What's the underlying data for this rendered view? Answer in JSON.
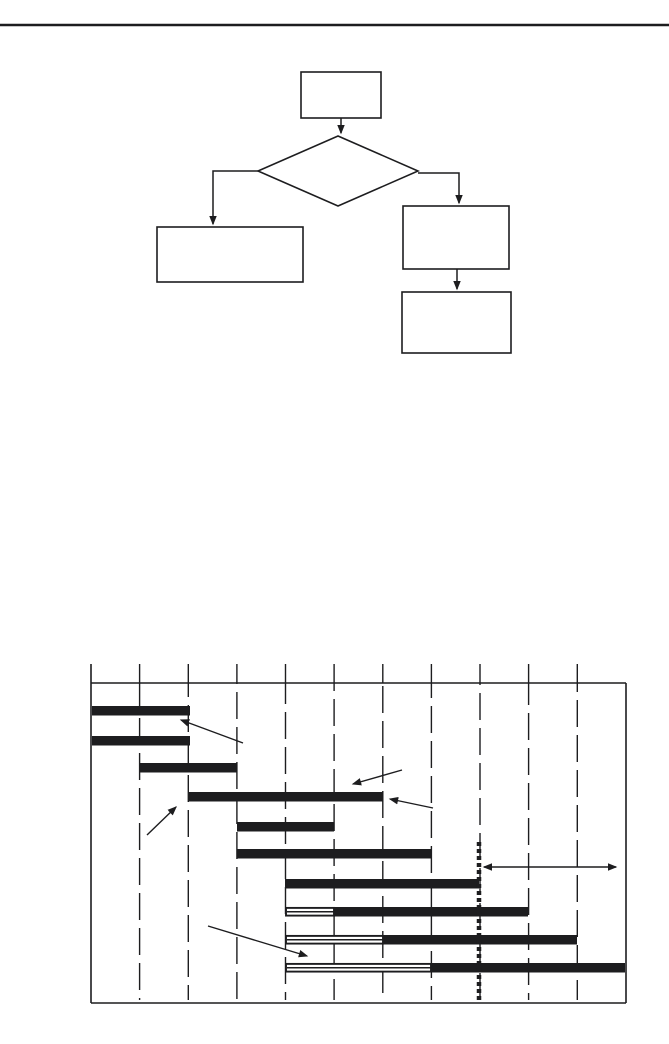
{
  "page": {
    "width": 669,
    "height": 1044,
    "background": "#ffffff",
    "ink": "#1d1d1f",
    "top_rule": {
      "x1": 0,
      "y": 25,
      "x2": 669,
      "thickness": 2.4
    }
  },
  "flowchart": {
    "nodes": [
      {
        "name": "flowchart-start-box",
        "shape": "rect",
        "x": 301,
        "y": 72,
        "w": 80,
        "h": 46
      },
      {
        "name": "flowchart-decision-diamond",
        "shape": "diamond",
        "points": [
          [
            338,
            136
          ],
          [
            418,
            171
          ],
          [
            338,
            206
          ],
          [
            258,
            171
          ]
        ]
      },
      {
        "name": "flowchart-left-result-box",
        "shape": "rect",
        "x": 157,
        "y": 227,
        "w": 146,
        "h": 55
      },
      {
        "name": "flowchart-right-process-box",
        "shape": "rect",
        "x": 403,
        "y": 206,
        "w": 106,
        "h": 63
      },
      {
        "name": "flowchart-right-final-box",
        "shape": "rect",
        "x": 402,
        "y": 292,
        "w": 109,
        "h": 61
      }
    ],
    "connectors": [
      {
        "name": "connector-start-to-decision",
        "points": [
          [
            341,
            118
          ],
          [
            341,
            133
          ]
        ]
      },
      {
        "name": "connector-decision-to-left-box",
        "points": [
          [
            258,
            171
          ],
          [
            213,
            171
          ],
          [
            213,
            224
          ]
        ]
      },
      {
        "name": "connector-decision-to-right-box",
        "points": [
          [
            418,
            173
          ],
          [
            459,
            173
          ],
          [
            459,
            203
          ]
        ]
      },
      {
        "name": "connector-right-box-to-final-box",
        "points": [
          [
            457,
            269
          ],
          [
            457,
            289
          ]
        ]
      }
    ]
  },
  "gantt": {
    "frame": {
      "left": 91,
      "top": 683,
      "right": 626,
      "bottom": 1003
    },
    "tick_top_y": 664,
    "gridline_xs": [
      139.6,
      188.3,
      236.9,
      285.5,
      334.1,
      382.8,
      431.4,
      480.0,
      528.6,
      577.3
    ],
    "grid_dash": "27 8",
    "bar_height": 9.5,
    "bars": [
      {
        "row": 1,
        "y": 706,
        "solid": [
          92,
          190
        ]
      },
      {
        "row": 2,
        "y": 736,
        "solid": [
          92,
          190
        ]
      },
      {
        "row": 3,
        "y": 763,
        "solid": [
          140,
          237
        ]
      },
      {
        "row": 4,
        "y": 792,
        "solid": [
          188,
          383
        ]
      },
      {
        "row": 5,
        "y": 822,
        "solid": [
          237,
          334
        ]
      },
      {
        "row": 6,
        "y": 849,
        "solid": [
          237,
          431
        ]
      },
      {
        "row": 7,
        "y": 879,
        "solid": [
          285,
          479
        ]
      },
      {
        "row": 8,
        "y": 907,
        "striped": [
          286,
          334
        ],
        "solid": [
          334,
          528
        ]
      },
      {
        "row": 9,
        "y": 935,
        "striped": [
          286,
          383
        ],
        "solid": [
          383,
          577
        ]
      },
      {
        "row": 10,
        "y": 963,
        "striped": [
          286,
          431
        ],
        "solid": [
          431,
          625
        ]
      }
    ],
    "status_date_line": {
      "x": 479,
      "y1": 842,
      "y2": 1000,
      "width": 4.5,
      "dash": "4 3"
    },
    "remaining_duration_arrow": {
      "y": 867,
      "x1": 484,
      "x2": 616
    },
    "annotation_arrows": [
      {
        "name": "annotation-arrow-top-bars",
        "from": [
          243,
          743
        ],
        "to": [
          181,
          720
        ]
      },
      {
        "name": "annotation-arrow-long-bar-top",
        "from": [
          402,
          770
        ],
        "to": [
          353,
          784
        ]
      },
      {
        "name": "annotation-arrow-long-bar-end",
        "from": [
          433,
          808
        ],
        "to": [
          390,
          799
        ]
      },
      {
        "name": "annotation-arrow-long-bar-start",
        "from": [
          147,
          835
        ],
        "to": [
          176,
          807
        ]
      },
      {
        "name": "annotation-arrow-striped-bars",
        "from": [
          208,
          926
        ],
        "to": [
          307,
          956
        ]
      }
    ]
  }
}
